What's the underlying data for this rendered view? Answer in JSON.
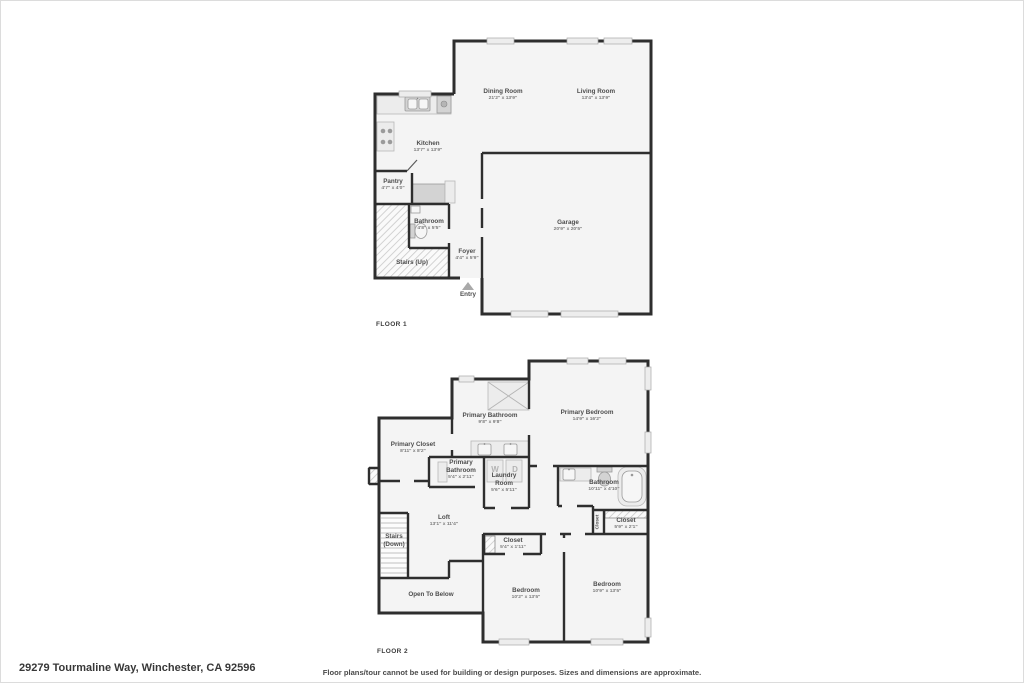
{
  "floor1": {
    "label": "FLOOR 1",
    "rooms": {
      "dining": {
        "name": "Dining Room",
        "dims": "21'2\" x 13'9\""
      },
      "living": {
        "name": "Living Room",
        "dims": "13'4\" x 13'9\""
      },
      "kitchen": {
        "name": "Kitchen",
        "dims": "13'7\" x 13'9\""
      },
      "pantry": {
        "name": "Pantry",
        "dims": "4'7\" x 4'0\""
      },
      "bathroom": {
        "name": "Bathroom",
        "dims": "4'8\" x 5'5\""
      },
      "stairs": {
        "name": "Stairs (Up)"
      },
      "foyer": {
        "name": "Foyer",
        "dims": "4'4\" x 5'9\""
      },
      "entry": {
        "name": "Entry"
      },
      "garage": {
        "name": "Garage",
        "dims": "20'9\" x 20'5\""
      }
    }
  },
  "floor2": {
    "label": "FLOOR 2",
    "rooms": {
      "primary_bathroom": {
        "name": "Primary Bathroom",
        "dims": "9'8\" x 9'8\""
      },
      "primary_bedroom": {
        "name": "Primary Bedroom",
        "dims": "14'9\" x 16'2\""
      },
      "primary_closet": {
        "name": "Primary Closet",
        "dims": "8'11\" x 8'2\""
      },
      "primary_bathroom_2": {
        "name": "Primary Bathroom",
        "dims": "5'4\" x 2'11\""
      },
      "laundry": {
        "name": "Laundry Room",
        "dims": "5'6\" x 5'11\""
      },
      "bathroom": {
        "name": "Bathroom",
        "dims": "10'11\" x 4'10\""
      },
      "closet_hall": {
        "name": "Closet"
      },
      "closet_right": {
        "name": "Closet",
        "dims": "5'9\" x 2'1\""
      },
      "loft": {
        "name": "Loft",
        "dims": "13'1\" x 11'4\""
      },
      "stairs": {
        "name": "Stairs (Down)"
      },
      "closet_mid": {
        "name": "Closet",
        "dims": "5'4\" x 1'11\""
      },
      "open_to_below": {
        "name": "Open To Below"
      },
      "bedroom_left": {
        "name": "Bedroom",
        "dims": "10'2\" x 13'5\""
      },
      "bedroom_right": {
        "name": "Bedroom",
        "dims": "10'9\" x 13'5\""
      },
      "washer": "W",
      "dryer": "D"
    }
  },
  "footer": {
    "address": "29279 Tourmaline Way, Winchester, CA 92596",
    "disclaimer": "Floor plans/tour cannot be used for building or design purposes. Sizes and dimensions are approximate."
  },
  "colors": {
    "wall": "#2e2e2e",
    "room_fill": "#f4f4f4",
    "accent_text": "#4d4d4d",
    "dim_text": "#7b7b7b"
  }
}
